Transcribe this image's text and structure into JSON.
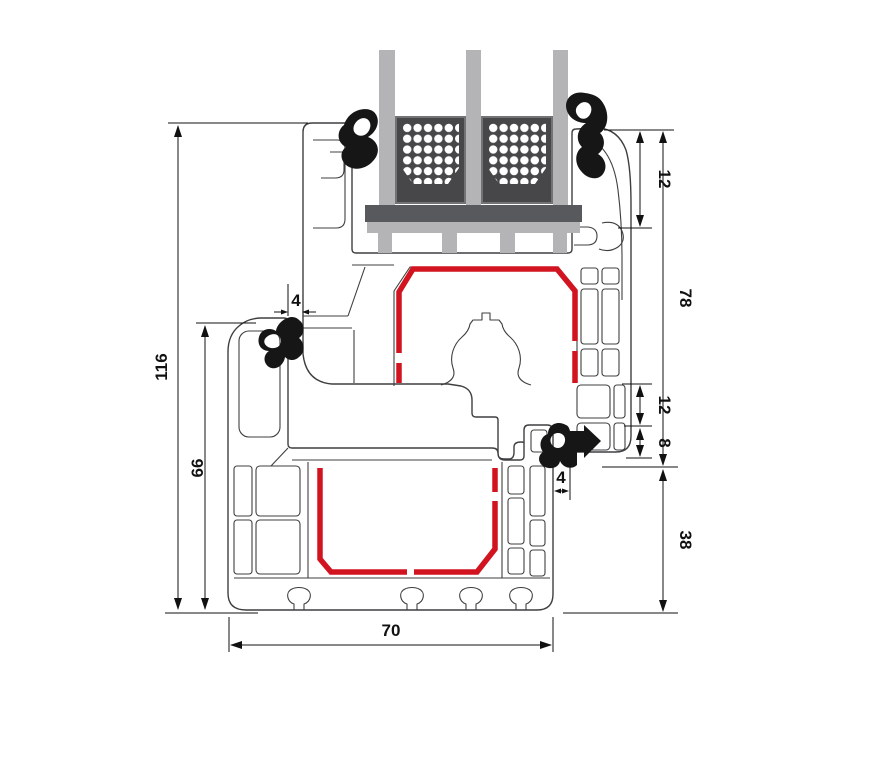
{
  "drawing": {
    "kind": "window-profile-cross-section"
  },
  "dimensions": {
    "total_height": {
      "value": "116"
    },
    "frame_height_left": {
      "value": "66"
    },
    "gap_top_left": {
      "value": "4"
    },
    "glazing_top": {
      "value": "12"
    },
    "sash_overall": {
      "value": "78"
    },
    "chamber_mid": {
      "value": "12"
    },
    "chamber_small": {
      "value": "8"
    },
    "gap_bottom_right": {
      "value": "4"
    },
    "frame_bottom": {
      "value": "38"
    },
    "total_width": {
      "value": "70"
    }
  },
  "colors": {
    "background": "#ffffff",
    "line": "#3f3f41",
    "dim": "#111111",
    "steel_red": "#d11420",
    "glass": "#b4b4b6",
    "spacer_dark": "#47474a",
    "spacer_border": "#737376",
    "block_dark": "#58595c",
    "gasket": "#161616",
    "dot": "#ffffff"
  }
}
